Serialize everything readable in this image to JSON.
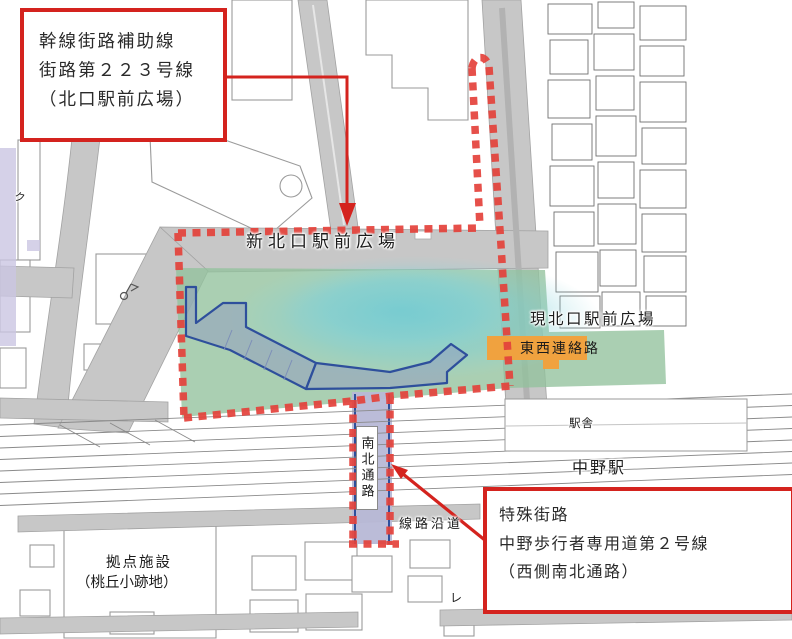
{
  "callouts": {
    "north_plaza": {
      "line1": "幹線街路補助線",
      "line2": "街路第２２３号線",
      "line3": "（北口駅前広場）"
    },
    "pedestrian_road": {
      "line1": "特殊街路",
      "line2": "中野歩行者専用道第２号線",
      "line3": "（西側南北通路）"
    }
  },
  "map_labels": {
    "shin_kitaguchi_plaza": "新北口駅前広場",
    "gen_kitaguchi_plaza": "現北口駅前広場",
    "tozai_renrakuro": "東西連絡路",
    "namboku_tsuro": "南北通路",
    "ekisha": "駅舎",
    "nakano_station": "中野駅",
    "senro_endo": "線路沿道",
    "kyoten_shisetsu_line1": "拠点施設",
    "kyoten_shisetsu_line2": "（桃丘小跡地）",
    "partial_left_char": "ク",
    "partial_bottom_char": "レ"
  },
  "colors": {
    "boundary_red": "#e4423b",
    "callout_red": "#d4231e",
    "road_gray": "#c7c7c7",
    "green_area": "#92c29c",
    "cyan_area": "#7ed0d8",
    "walkway_blue": "#2e4f9c",
    "corridor_lavender": "#b7b8d6",
    "tozai_orange": "#f0a23f"
  }
}
